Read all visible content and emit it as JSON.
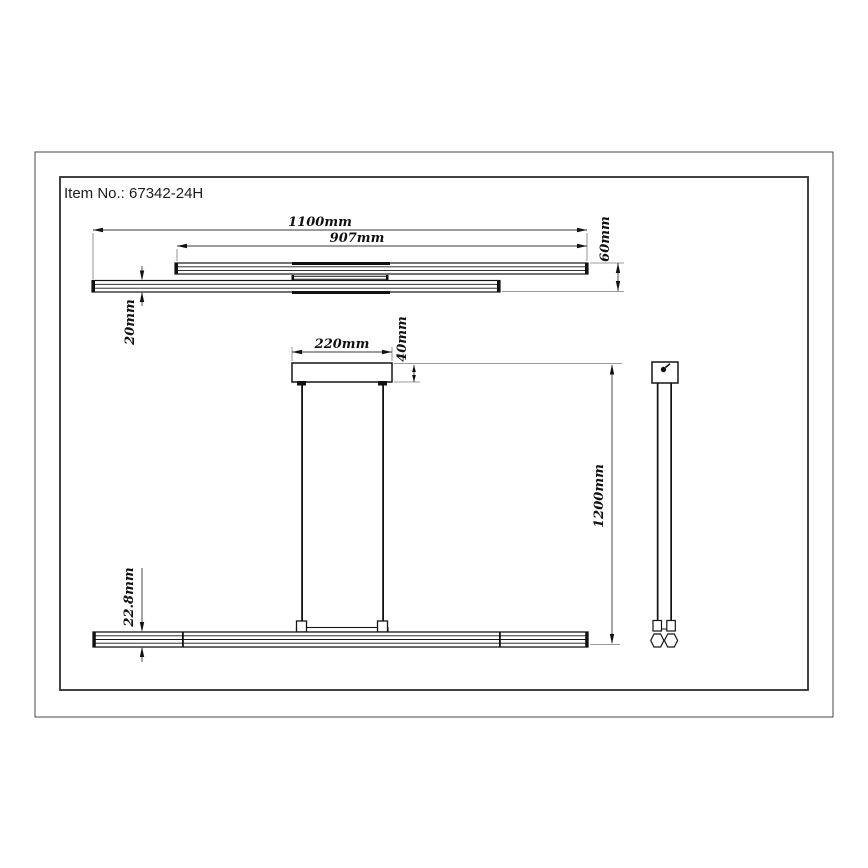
{
  "title_block": {
    "item_no": "Item No.: 67342-24H"
  },
  "dimensions": {
    "top_view": {
      "overall_length": "1100mm",
      "upper_bar_length": "907mm",
      "fixture_depth": "60mm",
      "bar_depth": "20mm"
    },
    "front_view": {
      "canopy_width": "220mm",
      "canopy_height": "40mm",
      "suspension_drop": "1200mm",
      "bar_profile_height": "22.8mm"
    }
  },
  "colors": {
    "background": "#ffffff",
    "geometry_line": "#151515",
    "dimension_line": "#3a3a3a",
    "extension_line": "#7a7a7a",
    "text": "#111111"
  }
}
